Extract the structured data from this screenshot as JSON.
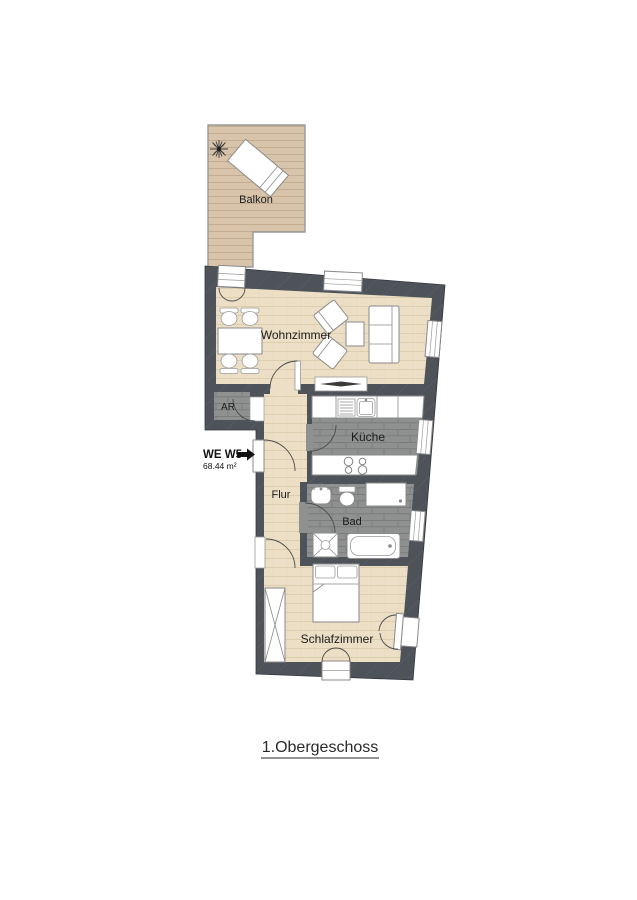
{
  "floor_plan": {
    "title": "1.Obergeschoss",
    "unit": {
      "id": "WE W5",
      "area": "68.44 m²"
    },
    "rooms": {
      "balcony": "Balkon",
      "living": "Wohnzimmer",
      "storage": "AR",
      "kitchen": "Küche",
      "hall": "Flur",
      "bath": "Bad",
      "bedroom": "Schlafzimmer"
    },
    "colors": {
      "wall": "#4d5359",
      "wood_floor": "#ecdfc6",
      "tile_floor": "#8f9090",
      "balcony_deck": "#d8c4aa"
    }
  }
}
